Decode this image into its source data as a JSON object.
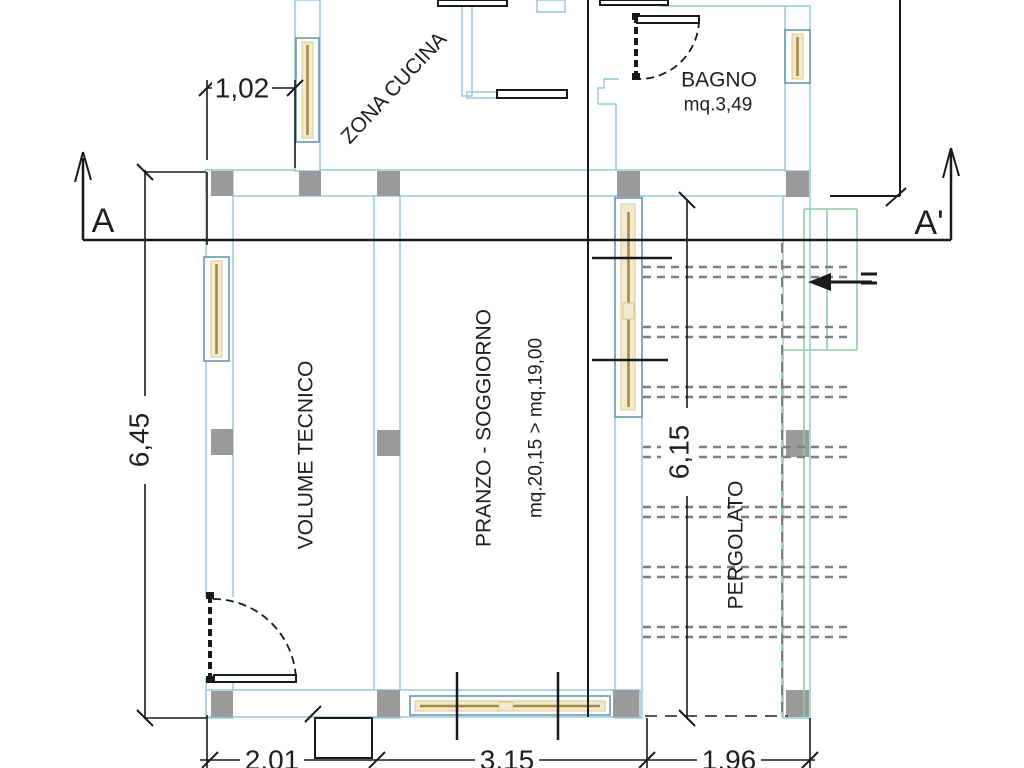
{
  "labels": {
    "kitchen": "ZONA CUCINA",
    "bathroom": "BAGNO",
    "bathroom_area": "mq.3,49",
    "technical_room": "VOLUME TECNICO",
    "living_room": "PRANZO - SOGGIORNO",
    "living_room_area": "mq.20,15 > mq.19,00",
    "pergola": "PERGOLATO",
    "section_start": "A",
    "section_end": "A'"
  },
  "dimensions": {
    "kitchen_window_width": "1,02",
    "left_side_height": "6,45",
    "pergola_side_height": "6,15",
    "bottom_span_left": "2,01",
    "bottom_span_center": "3,15",
    "bottom_span_right": "1,96"
  },
  "colors": {
    "wall_outline": "#8fc6d8",
    "window_frame": "#6699ad",
    "window_glass": "#a6883c",
    "window_glow": "#f3ead0",
    "window_glow_edge": "#d8c98c",
    "column_fill": "#9a9a9a",
    "pergola_outline": "#8fcba6",
    "beam_dash": "#7f7f7f",
    "ink": "#1a1a1a"
  }
}
